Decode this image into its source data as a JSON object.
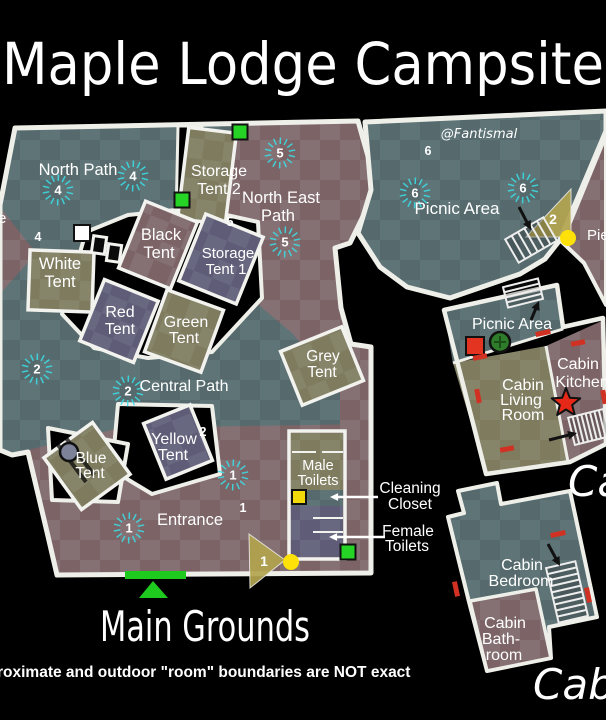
{
  "title": "Maple Lodge Campsite",
  "watermark": "@Fantismal",
  "footer_note": "roximate and outdoor \"room\" boundaries are NOT exact",
  "big_labels": {
    "main_grounds": "Main Grounds",
    "cabin_ground_floor": "Cabin",
    "cabin_first_floor_partial": "Ca"
  },
  "colors": {
    "teal": "#566a6d",
    "teal_light": "#5e7477",
    "mauve": "#7c6366",
    "mauve_light": "#857073",
    "olive": "#7e7b5f",
    "olive_light": "#878569",
    "slate": "#5e5c76",
    "slate_light": "#696881",
    "wall": "#efefea",
    "cyan": "#3ae0e8",
    "accent_green": "#25d425",
    "accent_yellow": "#f2d90a",
    "accent_red": "#d13122",
    "marker_gold": "#b3a54f",
    "arrow_black": "#111111"
  },
  "map": {
    "labels": [
      {
        "n": "north-path",
        "t": "North Path",
        "x": 78,
        "y": 175,
        "s": 16.5
      },
      {
        "n": "storage-tent-2-1",
        "t": "Storage",
        "x": 219,
        "y": 176,
        "s": 16
      },
      {
        "n": "storage-tent-2-2",
        "t": "Tent 2",
        "x": 219,
        "y": 194,
        "s": 16
      },
      {
        "n": "north-east-path-1",
        "t": "North East",
        "x": 281,
        "y": 203,
        "s": 16.5
      },
      {
        "n": "north-east-path-2",
        "t": "Path",
        "x": 278,
        "y": 221,
        "s": 16.5
      },
      {
        "n": "black-tent-1",
        "t": "Black",
        "x": 161,
        "y": 240,
        "s": 16.5
      },
      {
        "n": "black-tent-2",
        "t": "Tent",
        "x": 159,
        "y": 258,
        "s": 16.5
      },
      {
        "n": "white-tent-1",
        "t": "White",
        "x": 60,
        "y": 269,
        "s": 16.5
      },
      {
        "n": "white-tent-2",
        "t": "Tent",
        "x": 60,
        "y": 287,
        "s": 16.5
      },
      {
        "n": "storage-tent-1-1",
        "t": "Storage",
        "x": 228,
        "y": 258,
        "s": 15
      },
      {
        "n": "storage-tent-1-2",
        "t": "Tent 1",
        "x": 226,
        "y": 274,
        "s": 15
      },
      {
        "n": "red-tent-1",
        "t": "Red",
        "x": 120,
        "y": 317,
        "s": 16
      },
      {
        "n": "red-tent-2",
        "t": "Tent",
        "x": 120,
        "y": 334,
        "s": 16
      },
      {
        "n": "green-tent-1",
        "t": "Green",
        "x": 186,
        "y": 327,
        "s": 16
      },
      {
        "n": "green-tent-2",
        "t": "Tent",
        "x": 184,
        "y": 343,
        "s": 16
      },
      {
        "n": "grey-tent-1",
        "t": "Grey",
        "x": 323,
        "y": 361,
        "s": 15.5
      },
      {
        "n": "grey-tent-2",
        "t": "Tent",
        "x": 322,
        "y": 377,
        "s": 15.5
      },
      {
        "n": "central-path",
        "t": "Central Path",
        "x": 184,
        "y": 391,
        "s": 16
      },
      {
        "n": "yellow-tent-1",
        "t": "Yellow",
        "x": 174,
        "y": 444,
        "s": 16
      },
      {
        "n": "yellow-tent-2",
        "t": "Tent",
        "x": 173,
        "y": 460,
        "s": 16
      },
      {
        "n": "blue-tent-1",
        "t": "Blue",
        "x": 91,
        "y": 463,
        "s": 15.5
      },
      {
        "n": "blue-tent-2",
        "t": "Tent",
        "x": 90,
        "y": 478,
        "s": 15.5
      },
      {
        "n": "entrance",
        "t": "Entrance",
        "x": 190,
        "y": 525,
        "s": 16.5
      },
      {
        "n": "male-toilets-1",
        "t": "Male",
        "x": 318,
        "y": 470,
        "s": 14.5
      },
      {
        "n": "male-toilets-2",
        "t": "Toilets",
        "x": 318,
        "y": 485,
        "s": 14.5
      },
      {
        "n": "cleaning-closet-1",
        "t": "Cleaning",
        "x": 410,
        "y": 493,
        "s": 15.5
      },
      {
        "n": "cleaning-closet-2",
        "t": "Closet",
        "x": 410,
        "y": 509,
        "s": 15.5
      },
      {
        "n": "female-toilets-1",
        "t": "Female",
        "x": 408,
        "y": 536,
        "s": 15.5
      },
      {
        "n": "female-toilets-2",
        "t": "Toilets",
        "x": 407,
        "y": 551,
        "s": 15.5
      },
      {
        "n": "picnic-area-north",
        "t": "Picnic Area",
        "x": 457,
        "y": 214,
        "s": 17
      },
      {
        "n": "picnic-area-cabin",
        "t": "Picnic Area",
        "x": 512,
        "y": 329,
        "s": 16
      },
      {
        "n": "cabin-living-1",
        "t": "Cabin",
        "x": 523,
        "y": 390,
        "s": 16
      },
      {
        "n": "cabin-living-2",
        "t": "Living",
        "x": 521,
        "y": 405,
        "s": 16
      },
      {
        "n": "cabin-living-3",
        "t": "Room",
        "x": 523,
        "y": 420,
        "s": 16
      },
      {
        "n": "cabin-kitchen-1",
        "t": "Cabin",
        "x": 578,
        "y": 369,
        "s": 16
      },
      {
        "n": "cabin-kitchen-2",
        "t": "Kitchen",
        "x": 582,
        "y": 387,
        "s": 16
      },
      {
        "n": "cabin-bedroom-1",
        "t": "Cabin",
        "x": 522,
        "y": 570,
        "s": 16
      },
      {
        "n": "cabin-bedroom-2",
        "t": "Bedroom",
        "x": 521,
        "y": 586,
        "s": 16
      },
      {
        "n": "cabin-bathroom-1",
        "t": "Cabin",
        "x": 505,
        "y": 628,
        "s": 16
      },
      {
        "n": "cabin-bathroom-2",
        "t": "Bath-",
        "x": 501,
        "y": 644,
        "s": 16
      },
      {
        "n": "cabin-bathroom-3",
        "t": "room",
        "x": 504,
        "y": 660,
        "s": 16
      },
      {
        "n": "pier-partial",
        "t": "Pie",
        "x": 587,
        "y": 240,
        "s": 15,
        "a": "start"
      },
      {
        "n": "west-partial",
        "t": "e",
        "x": -2,
        "y": 223,
        "s": 15,
        "a": "start"
      }
    ],
    "numbers": {
      "bursts": [
        {
          "t": "4",
          "x": 58,
          "y": 190
        },
        {
          "t": "4",
          "x": 133,
          "y": 176
        },
        {
          "t": "2",
          "x": 37,
          "y": 369
        },
        {
          "t": "2",
          "x": 128,
          "y": 391
        },
        {
          "t": "5",
          "x": 280,
          "y": 153
        },
        {
          "t": "5",
          "x": 285,
          "y": 242
        },
        {
          "t": "6",
          "x": 415,
          "y": 193
        },
        {
          "t": "6",
          "x": 523,
          "y": 188
        },
        {
          "t": "1",
          "x": 233,
          "y": 475
        },
        {
          "t": "1",
          "x": 129,
          "y": 528
        }
      ],
      "plain": [
        {
          "t": "4",
          "x": 38,
          "y": 237
        },
        {
          "t": "5",
          "x": 230,
          "y": 222
        },
        {
          "t": "6",
          "x": 428,
          "y": 151
        },
        {
          "t": "2",
          "x": 203,
          "y": 432
        },
        {
          "t": "1",
          "x": 243,
          "y": 508
        }
      ],
      "markers": [
        {
          "t": "2",
          "x": 553,
          "y": 224
        },
        {
          "t": "1",
          "x": 264,
          "y": 566
        }
      ]
    },
    "icons": {
      "squares": [
        {
          "n": "door-white-square",
          "x": 82,
          "y": 233,
          "s": 16,
          "f": "#ffffff"
        },
        {
          "n": "door-green-square-1",
          "x": 182,
          "y": 200,
          "s": 15,
          "f": "#25d425"
        },
        {
          "n": "door-green-square-2",
          "x": 240,
          "y": 132,
          "s": 15,
          "f": "#25d425"
        },
        {
          "n": "door-green-square-3",
          "x": 348,
          "y": 552,
          "s": 15,
          "f": "#25d425"
        },
        {
          "n": "door-yellow-square",
          "x": 299,
          "y": 497,
          "s": 14,
          "f": "#f2d90a"
        },
        {
          "n": "obj-red-square",
          "x": 475,
          "y": 346,
          "s": 18,
          "f": "#e23420"
        }
      ],
      "dots": [
        {
          "n": "dot-yellow-pier",
          "x": 568,
          "y": 238,
          "r": 8
        },
        {
          "n": "dot-yellow-toilets",
          "x": 291,
          "y": 562,
          "r": 8
        }
      ],
      "circles": [
        {
          "n": "obj-blue-circle",
          "x": 69,
          "y": 452,
          "r": 9,
          "f": "#7d8298"
        },
        {
          "n": "obj-tree-circle",
          "x": 500,
          "y": 342,
          "r": 10,
          "f": "#2f7d2a"
        }
      ],
      "triangles": [
        {
          "n": "level-marker-2",
          "pts": "526,237 571,189 571,237"
        },
        {
          "n": "level-marker-1",
          "pts": "249,534 285,560 250,588"
        }
      ],
      "star": {
        "n": "obj-red-star",
        "x": 566,
        "y": 403,
        "r1": 15,
        "r2": 6.5
      },
      "stairs": [
        {
          "n": "stairs-picnic-north",
          "x": 531,
          "y": 240,
          "w": 44,
          "h": 27,
          "r": -30,
          "steps": 6,
          "dir": "v"
        },
        {
          "n": "stairs-cabin-deck",
          "x": 523,
          "y": 293,
          "w": 36,
          "h": 21,
          "r": -14,
          "steps": 4,
          "dir": "h"
        },
        {
          "n": "stairs-cabin-kitchen",
          "x": 589,
          "y": 427,
          "w": 36,
          "h": 28,
          "r": -14,
          "steps": 8,
          "dir": "v"
        },
        {
          "n": "stairs-cabin-bedroom",
          "x": 567,
          "y": 592,
          "w": 30,
          "h": 56,
          "r": -13,
          "steps": 9,
          "dir": "h"
        }
      ],
      "arrows_black": [
        {
          "n": "arrow-to-picnic-stairs",
          "x1": 519,
          "y1": 207,
          "x2": 531,
          "y2": 230
        },
        {
          "n": "arrow-to-deck-stairs",
          "x1": 531,
          "y1": 320,
          "x2": 539,
          "y2": 301
        },
        {
          "n": "arrow-to-kitchen-stairs",
          "x1": 549,
          "y1": 440,
          "x2": 577,
          "y2": 433
        },
        {
          "n": "arrow-to-bedroom-stairs",
          "x1": 548,
          "y1": 544,
          "x2": 560,
          "y2": 566
        }
      ],
      "arrows_white": [
        {
          "n": "arrow-cleaning-closet",
          "x1": 378,
          "y1": 497,
          "x2": 330,
          "y2": 497
        },
        {
          "n": "arrow-female-toilets",
          "x1": 385,
          "y1": 537,
          "x2": 329,
          "y2": 537
        }
      ],
      "doors_red": [
        {
          "x": 543,
          "y": 333,
          "w": 15,
          "h": 5,
          "r": -12
        },
        {
          "x": 480,
          "y": 357,
          "w": 14,
          "h": 5,
          "r": -12
        },
        {
          "x": 478,
          "y": 396,
          "w": 5,
          "h": 14,
          "r": -11
        },
        {
          "x": 507,
          "y": 449,
          "w": 14,
          "h": 5,
          "r": -11
        },
        {
          "x": 578,
          "y": 343,
          "w": 14,
          "h": 5,
          "r": -11
        },
        {
          "x": 604,
          "y": 397,
          "w": 5,
          "h": 14,
          "r": -11
        },
        {
          "x": 558,
          "y": 534,
          "w": 15,
          "h": 5,
          "r": -12
        },
        {
          "x": 588,
          "y": 595,
          "w": 5,
          "h": 15,
          "r": -12
        },
        {
          "x": 456,
          "y": 589,
          "w": 5,
          "h": 15,
          "r": -12
        }
      ],
      "posts": [
        {
          "x": 99,
          "y": 245,
          "w": 13,
          "h": 17,
          "r": 8
        },
        {
          "x": 114,
          "y": 253,
          "w": 13,
          "h": 17,
          "r": 8
        }
      ],
      "entrance_marker": {
        "bar": {
          "x": 125,
          "y": 571,
          "w": 61,
          "h": 8
        },
        "tri": "153,581 139,598 168,598"
      }
    }
  }
}
